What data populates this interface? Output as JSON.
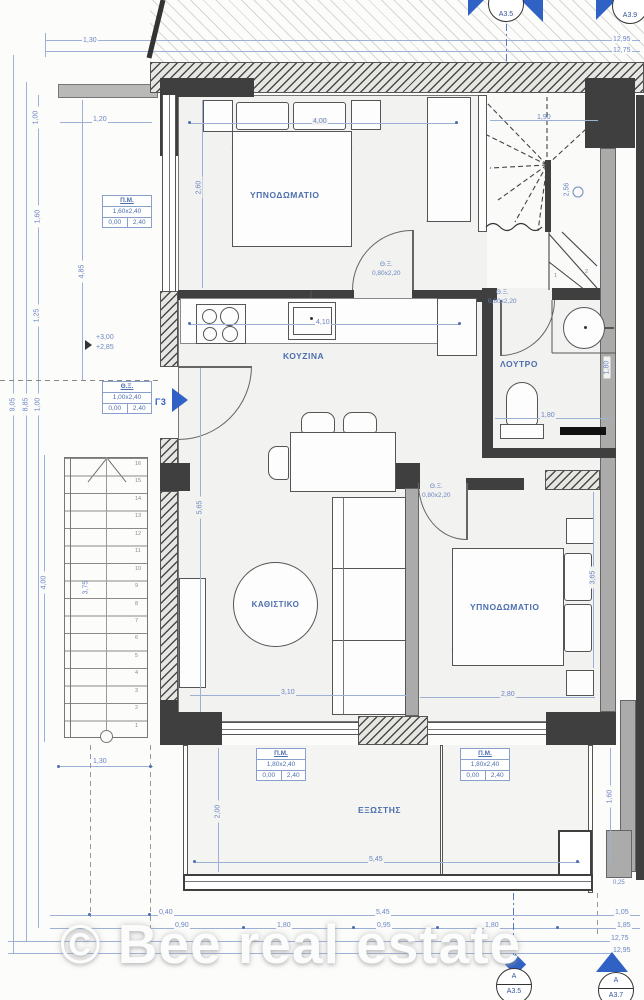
{
  "watermark": "© Bee real estate",
  "rooms": {
    "bedroom1": "ΥΠΝΟΔΩΜΑΤΙΟ",
    "kitchen": "ΚΟΥΖΙΝΑ",
    "bathroom": "ΛΟΥΤΡΟ",
    "living": "ΚΑΘΙΣΤΙΚΟ",
    "bedroom2": "ΥΠΝΟΔΩΜΑΤΙΟ",
    "balcony": "ΕΞΩΣΤΗΣ"
  },
  "entrance": {
    "door_label": "Γ3"
  },
  "levels": {
    "upper": "+3,00",
    "lower": "+2,85"
  },
  "doors": {
    "code": "Θ.Ξ.",
    "size": "0,80x2,20"
  },
  "specs": {
    "entrance": {
      "title": "Θ.Ξ.",
      "size": "1,00x2,40",
      "c1": "0,00",
      "c2": "2,40"
    },
    "window_left": {
      "title": "Π.Μ.",
      "size": "1,60x2,40",
      "c1": "0,00",
      "c2": "2,40"
    },
    "window_balcony": {
      "title": "Π.Μ.",
      "size": "1,80x2,40",
      "c1": "0,00",
      "c2": "2,40"
    }
  },
  "markers": {
    "top": "A3.5",
    "top_right": "A3.9",
    "bottom_letter": "A",
    "bottom": "A3.5",
    "bottom_right_letter": "A",
    "bottom_right": "A3.7"
  },
  "stairs": {
    "exterior_steps": [
      "16",
      "15",
      "14",
      "13",
      "12",
      "11",
      "10",
      "9",
      "8",
      "7",
      "6",
      "5",
      "4",
      "3",
      "2",
      "1"
    ],
    "interior_steps": [
      "1",
      "2"
    ]
  },
  "dims": {
    "roof_offset": "1,30",
    "total_top_1": "12,95",
    "total_top_2": "12,75",
    "top_left_1_20": "1,20",
    "left_1_00_top": "1,00",
    "left_1_60": "1,60",
    "left_1_25": "1,25",
    "left_9_05": "9,05",
    "left_8_85": "8,85",
    "left_1_00": "1,00",
    "left_4_85": "4,85",
    "bed1_w": "4,00",
    "bed1_h": "2,60",
    "stair_w": "1,90",
    "stair_h": "2,56",
    "kitchen_w": "4,10",
    "bath_w": "1,80",
    "bath_h": "1,80",
    "living_h": "5,65",
    "living_w": "3,10",
    "bed2_w": "2,80",
    "bed2_h": "3,65",
    "ext_stair_total": "4,00",
    "ext_stair_run": "3,75",
    "ext_stair_w": "1,30",
    "balcony_h": "2,00",
    "balcony_w": "5,45",
    "balcony_right": "1,60",
    "pier": "0,25",
    "bottom_0_40": "0,40",
    "bottom_5_45": "5,45",
    "bottom_1_05": "1,05",
    "bottom_0_90": "0,90",
    "bottom_1_80a": "1,80",
    "bottom_0_95": "0,95",
    "bottom_1_80b": "1,80",
    "bottom_1_85": "1,85",
    "bottom_total_1": "12,75",
    "bottom_total_2": "12,95"
  }
}
